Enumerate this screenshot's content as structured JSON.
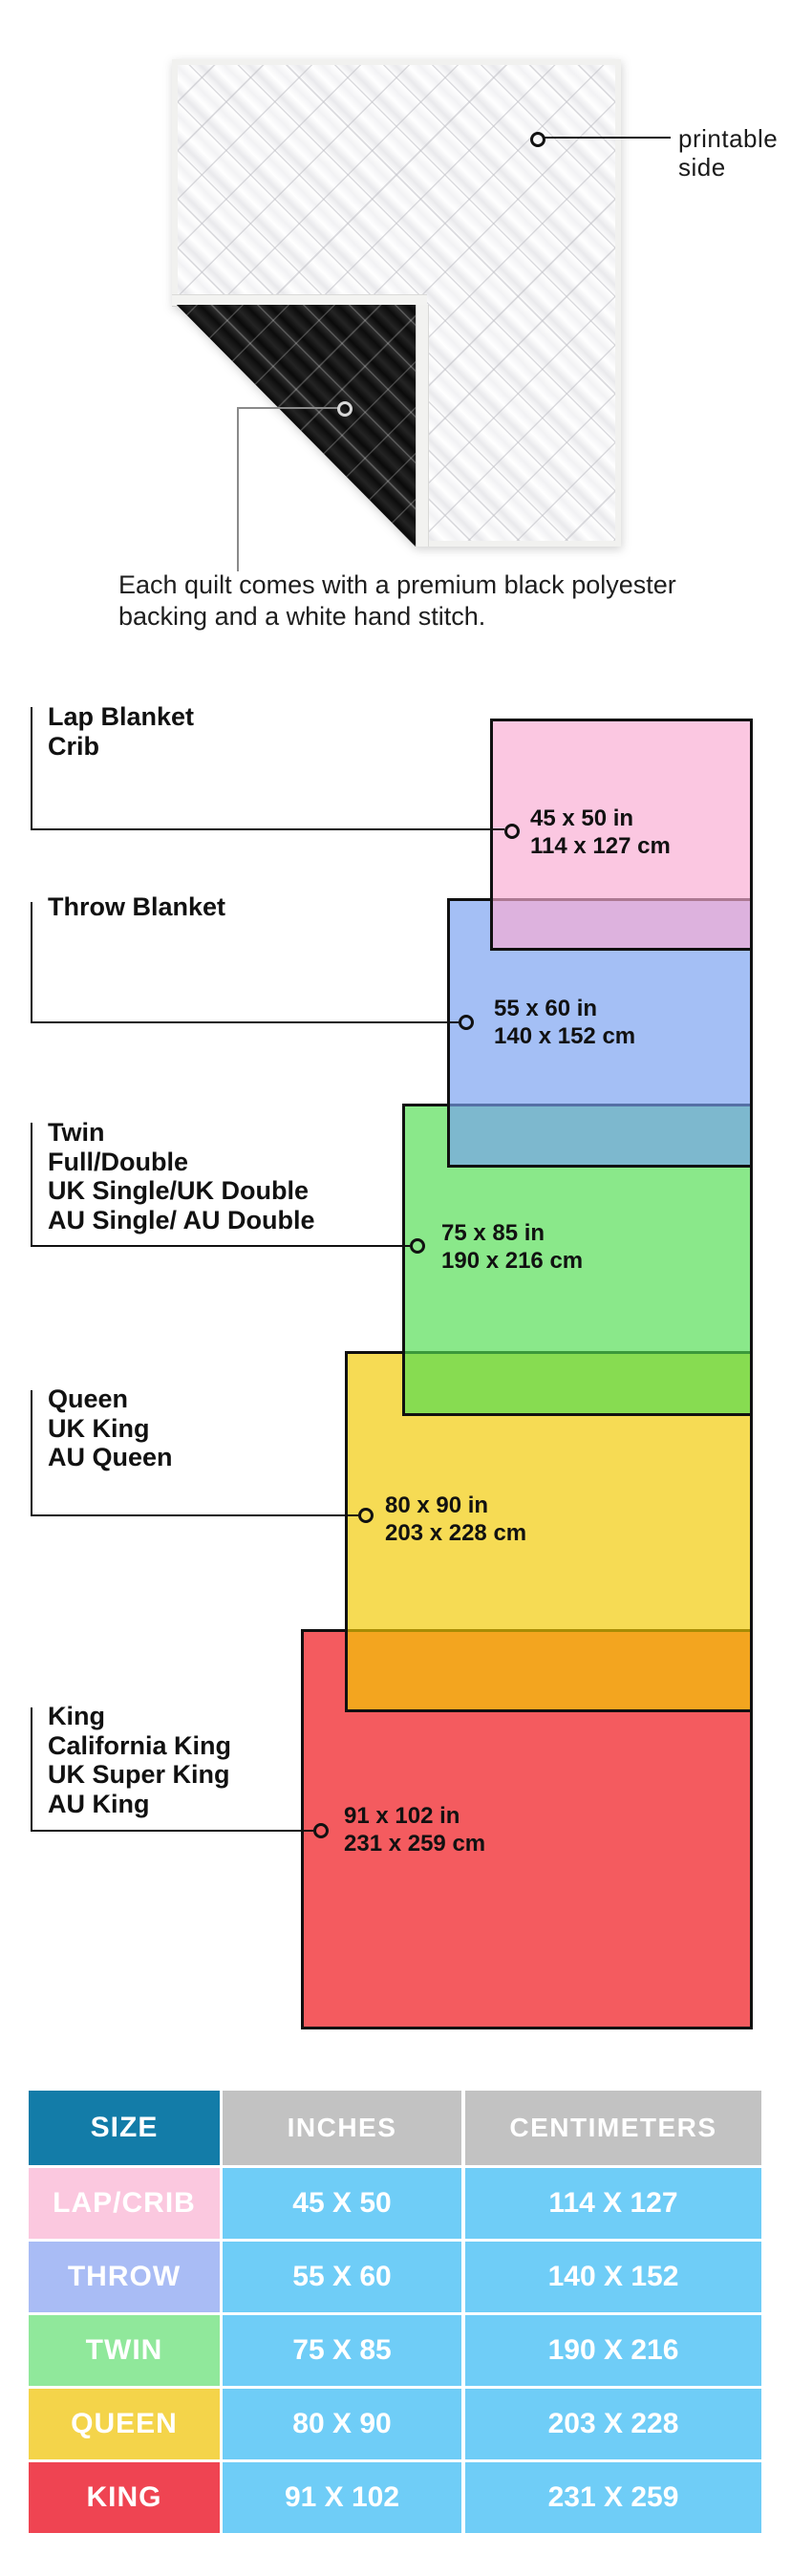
{
  "hero": {
    "printable_label_line1": "printable",
    "printable_label_line2": "side",
    "caption_line1": "Each quilt comes with a premium black polyester",
    "caption_line2": "backing and a white hand stitch.",
    "front_color": "#f8f8f8",
    "backing_color": "#131313"
  },
  "diagram": {
    "border_color": "#101010",
    "sizes": [
      {
        "label_lines": [
          "Lap Blanket",
          "Crib"
        ],
        "dims_in": "45 x 50 in",
        "dims_cm": "114 x 127 cm",
        "fill_color": "#FBC8E1"
      },
      {
        "label_lines": [
          "Throw Blanket"
        ],
        "dims_in": "55 x 60 in",
        "dims_cm": "140 x 152 cm",
        "fill_color": "#A5C0F5"
      },
      {
        "label_lines": [
          "Twin",
          "Full/Double",
          "UK Single/UK Double",
          "AU Single/ AU Double"
        ],
        "dims_in": "75 x 85 in",
        "dims_cm": "190 x 216 cm",
        "fill_color": "#8BEA8B"
      },
      {
        "label_lines": [
          "Queen",
          "UK King",
          "AU Queen"
        ],
        "dims_in": "80 x 90 in",
        "dims_cm": "203 x 228 cm",
        "fill_color": "#F6DC4E"
      },
      {
        "label_lines": [
          "King",
          "California King",
          "UK Super King",
          "AU King"
        ],
        "dims_in": "91 x 102 in",
        "dims_cm": "231 x 259 cm",
        "fill_color": "#F4555C"
      }
    ]
  },
  "table": {
    "headers": {
      "size": "SIZE",
      "inches": "INCHES",
      "centimeters": "CENTIMETERS"
    },
    "header_size_color": "#137CA8",
    "header_other_color": "#C2C2C2",
    "value_cell_color": "#6FCDF7",
    "rows": [
      {
        "size": "LAP/CRIB",
        "inches": "45 X 50",
        "centimeters": "114 X 127",
        "row_color": "#FBC8DF"
      },
      {
        "size": "THROW",
        "inches": "55 X 60",
        "centimeters": "140 X 152",
        "row_color": "#A9BCF5"
      },
      {
        "size": "TWIN",
        "inches": "75 X 85",
        "centimeters": "190 X 216",
        "row_color": "#90E89B"
      },
      {
        "size": "QUEEN",
        "inches": "80 X 90",
        "centimeters": "203 X 228",
        "row_color": "#F4D44A"
      },
      {
        "size": "KING",
        "inches": "91 X 102",
        "centimeters": "231 X 259",
        "row_color": "#EF4452"
      }
    ]
  }
}
